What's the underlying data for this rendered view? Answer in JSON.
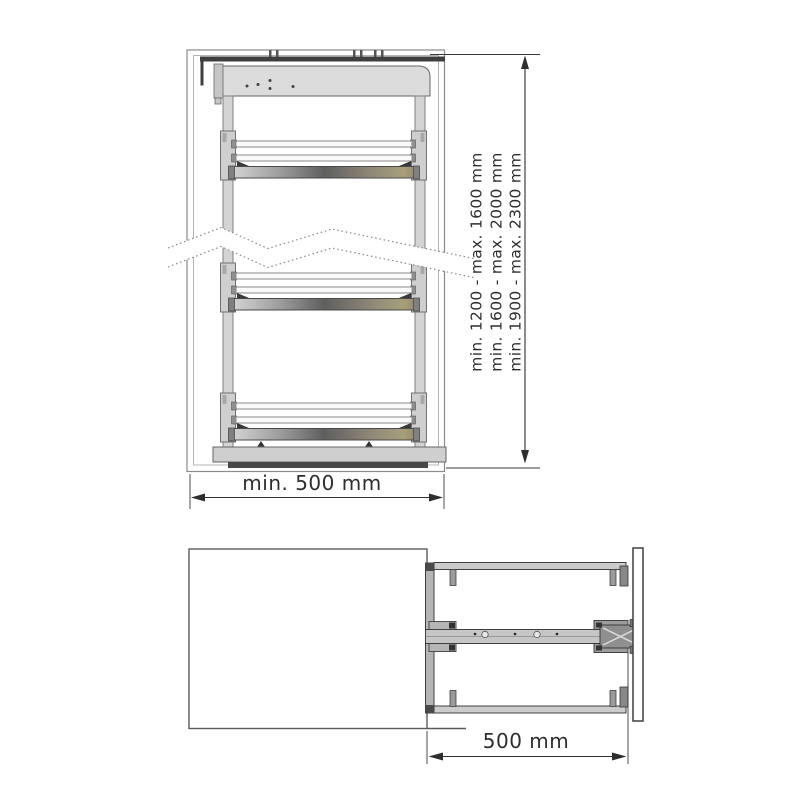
{
  "front_view": {
    "height_labels": [
      "min. 1200 - max. 1600 mm",
      "min. 1600 - max. 2000 mm",
      "min. 1900 - max. 2300 mm"
    ],
    "width_label": "min. 500 mm"
  },
  "top_view": {
    "depth_label": "500 mm"
  },
  "colors": {
    "dimension_line": "#333333",
    "cabinet_outline": "#8a8a8a",
    "metal_dark": "#3f3f3f",
    "metal_mid": "#b5b5b5",
    "metal_light": "#cccccc",
    "panel_gray": "#dcdcdc",
    "shelf_band_olive": "#8a8468"
  }
}
